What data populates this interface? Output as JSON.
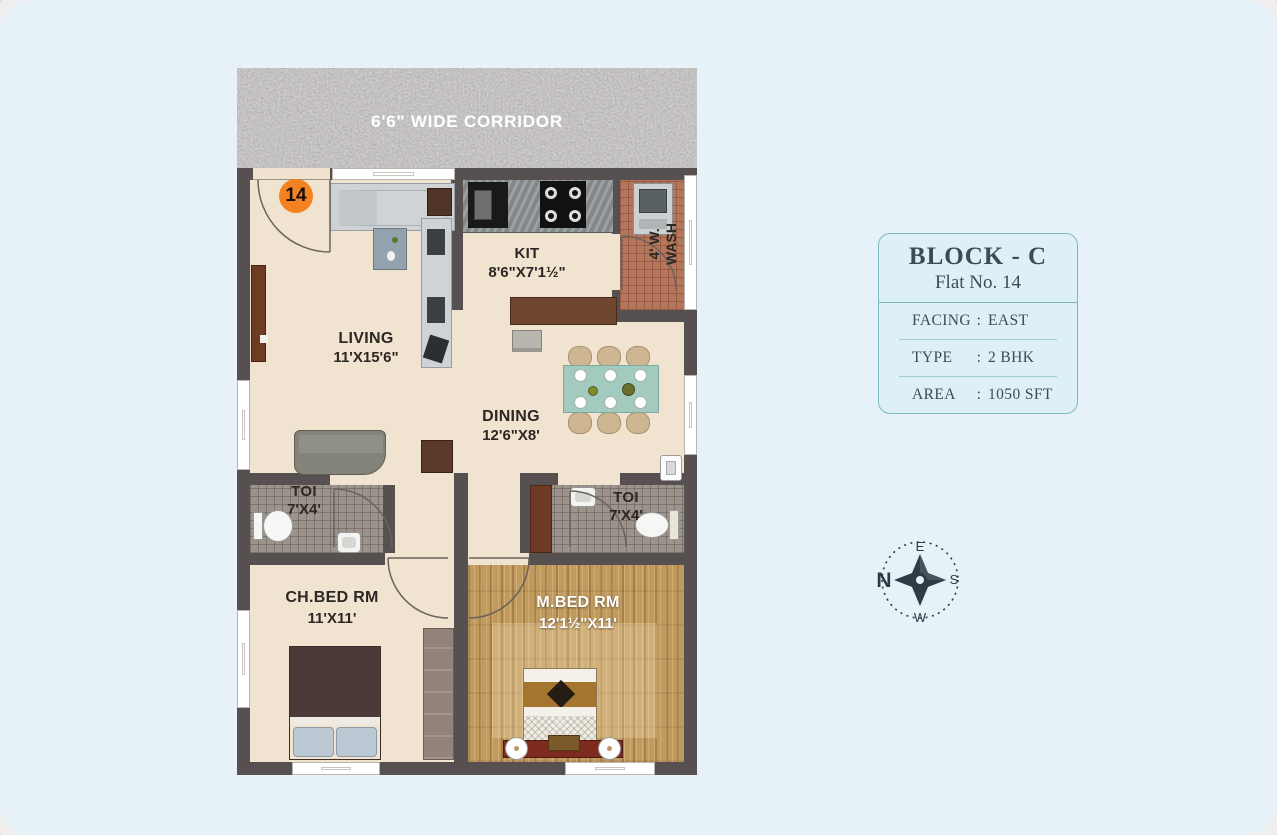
{
  "floor_plan": {
    "corridor_label": "6'6\" WIDE CORRIDOR",
    "flat_number": "14",
    "rooms": {
      "living": {
        "name": "LIVING",
        "dims": "11'X15'6\""
      },
      "kitchen": {
        "name": "KIT",
        "dims": "8'6\"X7'1½\""
      },
      "dining": {
        "name": "DINING",
        "dims": "12'6\"X8'"
      },
      "toilet_left": {
        "name": "TOI",
        "dims": "7'X4'"
      },
      "toilet_right": {
        "name": "TOI",
        "dims": "7'X4'"
      },
      "child_bedroom": {
        "name": "CH.BED RM",
        "dims": "11'X11'"
      },
      "master_bedroom": {
        "name": "M.BED RM",
        "dims": "12'1½\"X11'"
      },
      "wash": {
        "line1": "4' W.",
        "line2": "WASH"
      }
    }
  },
  "info_card": {
    "title": "BLOCK - C",
    "subtitle": "Flat No. 14",
    "rows": [
      {
        "label": "FACING",
        "separator": ":",
        "value": "EAST"
      },
      {
        "label": "TYPE",
        "separator": ":",
        "value": "2 BHK"
      },
      {
        "label": "AREA",
        "separator": ":",
        "value": "1050 SFT"
      }
    ]
  },
  "compass": {
    "north": "N",
    "east": "E",
    "south": "S",
    "west": "W"
  },
  "colors": {
    "page_background": "#e6f2f8",
    "wall": "#575050",
    "accent_orange": "#f58220",
    "card_border": "#7fb9c0",
    "compass_ink": "#2e3a44",
    "label_dark": "#2b2724",
    "label_light": "#ffffff"
  }
}
